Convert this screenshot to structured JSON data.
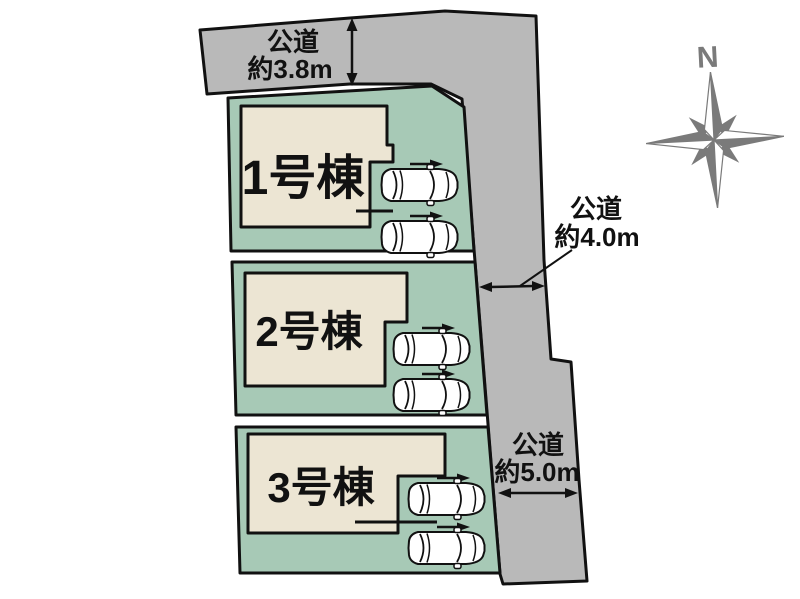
{
  "site_plan": {
    "compass": {
      "north_label": "N"
    },
    "roads": {
      "top": {
        "name": "公道",
        "width": "約3.8m"
      },
      "right_upper": {
        "name": "公道",
        "width": "約4.0m"
      },
      "right_lower": {
        "name": "公道",
        "width": "約5.0m"
      }
    },
    "lots": {
      "lot1": {
        "label": "1号棟",
        "car_count": 2
      },
      "lot2": {
        "label": "2号棟",
        "car_count": 2
      },
      "lot3": {
        "label": "3号棟",
        "car_count": 2
      }
    },
    "colors": {
      "road": "#b9b9b9",
      "lot": "#a7c9b6",
      "building": "#ece5d3",
      "outline": "#111111",
      "compass": "#7a7a7a",
      "background": "#ffffff"
    }
  }
}
